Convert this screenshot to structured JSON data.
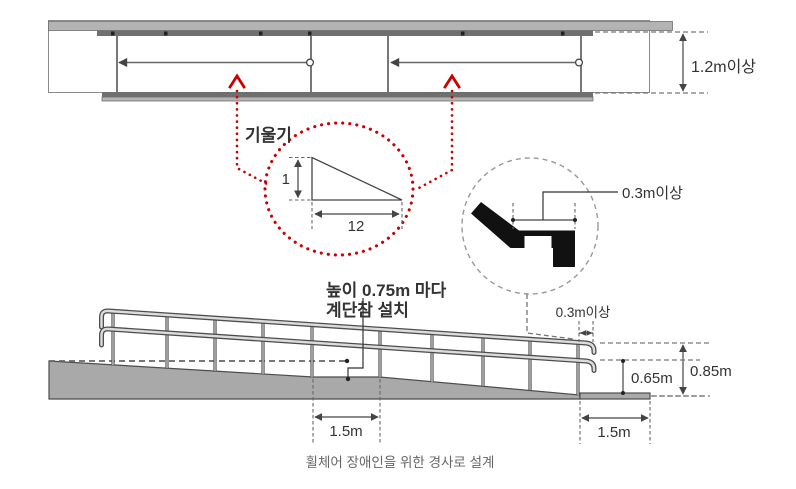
{
  "caption": "휠체어 장애인을 위한 경사로 설계",
  "plan_view": {
    "clear_width": "1.2m이상"
  },
  "slope": {
    "label": "기울기",
    "rise": "1",
    "run": "12"
  },
  "handrail_detail": {
    "extension": "0.3m이상"
  },
  "elevation": {
    "landing_note_1": "높이 0.75m 마다",
    "landing_note_2": "계단참 설치",
    "rail_extension": "0.3m이상",
    "upper_rail_height": "0.85m",
    "lower_rail_height": "0.65m",
    "mid_landing_length": "1.5m",
    "end_landing_length": "1.5m"
  },
  "colors": {
    "accent_red": "#cc0000",
    "structure_gray": "#a9a9a9",
    "rail_dark": "#4d4d4d"
  }
}
